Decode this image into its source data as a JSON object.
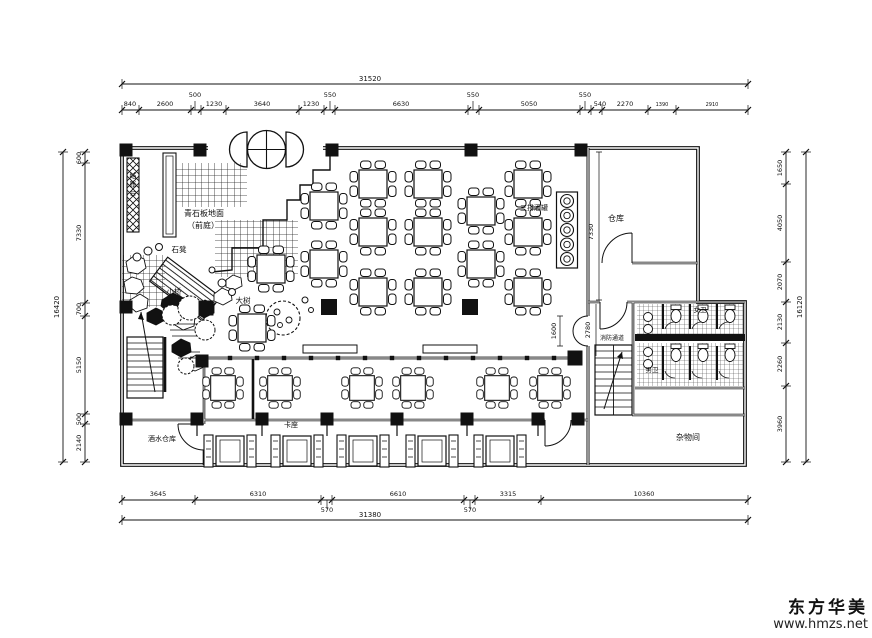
{
  "watermark": {
    "brand": "东方华美",
    "url": "www.hmzs.net"
  },
  "plan_labels": [
    {
      "id": "cashier-desk",
      "text": "结账台",
      "x": 133,
      "y": 178,
      "mode": "stack",
      "size": 7
    },
    {
      "id": "bluestone-paving",
      "text": "青石板地面",
      "x": 204,
      "y": 216,
      "mode": "h",
      "size": 8
    },
    {
      "id": "front-court",
      "text": "（前庭）",
      "x": 203,
      "y": 228,
      "mode": "h",
      "size": 8
    },
    {
      "id": "stone-bench",
      "text": "石凳",
      "x": 179,
      "y": 252,
      "mode": "h",
      "size": 7.5
    },
    {
      "id": "small-bridge",
      "text": "小桥",
      "x": 174,
      "y": 294,
      "mode": "h",
      "size": 7.5
    },
    {
      "id": "big-tree",
      "text": "大树",
      "x": 243,
      "y": 303,
      "mode": "h",
      "size": 7.5
    },
    {
      "id": "three-rows-wine-jars",
      "text": "三排酒罐",
      "x": 534,
      "y": 210,
      "mode": "h",
      "size": 7
    },
    {
      "id": "warehouse",
      "text": "仓库",
      "x": 616,
      "y": 221,
      "mode": "h",
      "size": 8
    },
    {
      "id": "dim-7330",
      "text": "7330",
      "x": 593,
      "y": 232,
      "mode": "rot",
      "size": 6.5
    },
    {
      "id": "dim-1600",
      "text": "1600",
      "x": 556,
      "y": 331,
      "mode": "rot",
      "size": 6.5
    },
    {
      "id": "dim-2780",
      "text": "2780",
      "x": 590,
      "y": 330,
      "mode": "rot",
      "size": 6.5
    },
    {
      "id": "fire-passage",
      "text": "消防通道",
      "x": 612,
      "y": 340,
      "mode": "h",
      "size": 6
    },
    {
      "id": "womens-wc",
      "text": "女卫",
      "x": 700,
      "y": 312,
      "mode": "h",
      "size": 6.5
    },
    {
      "id": "mens-wc",
      "text": "男卫",
      "x": 652,
      "y": 372,
      "mode": "h",
      "size": 6.5
    },
    {
      "id": "storage-room",
      "text": "杂物间",
      "x": 688,
      "y": 440,
      "mode": "h",
      "size": 8
    },
    {
      "id": "drinks-warehouse",
      "text": "酒水仓库",
      "x": 162,
      "y": 441,
      "mode": "h",
      "size": 7
    },
    {
      "id": "booth-seating",
      "text": "卡座",
      "x": 291,
      "y": 427,
      "mode": "h",
      "size": 7
    }
  ],
  "dim_chains": {
    "top": {
      "orient": "h",
      "total": "31520",
      "total_pos": 84,
      "total_label_at": 370,
      "a": 122,
      "b": 748,
      "seg_pos": 110,
      "ticks": [
        122,
        139,
        191,
        201,
        226,
        299,
        324,
        335,
        468,
        479,
        580,
        591,
        602,
        648,
        676,
        748
      ],
      "labels": [
        {
          "t": "840",
          "at": 130
        },
        {
          "t": "2600",
          "at": 165
        },
        {
          "t": "500",
          "at": 195,
          "raise": true
        },
        {
          "t": "1230",
          "at": 214
        },
        {
          "t": "3640",
          "at": 262
        },
        {
          "t": "1230",
          "at": 311
        },
        {
          "t": "550",
          "at": 330,
          "raise": true
        },
        {
          "t": "6630",
          "at": 401
        },
        {
          "t": "550",
          "at": 473,
          "raise": true
        },
        {
          "t": "5050",
          "at": 529
        },
        {
          "t": "550",
          "at": 585,
          "raise": true
        },
        {
          "t": "540",
          "at": 600
        },
        {
          "t": "2270",
          "at": 625
        },
        {
          "t": "1390",
          "at": 662,
          "small": true
        },
        {
          "t": "2910",
          "at": 712,
          "small": true
        }
      ]
    },
    "bottom": {
      "orient": "h",
      "total": "31380",
      "total_pos": 520,
      "total_label_at": 370,
      "a": 122,
      "b": 748,
      "seg_pos": 500,
      "ticks": [
        122,
        195,
        321,
        332,
        464,
        475,
        541,
        748
      ],
      "labels": [
        {
          "t": "3645",
          "at": 158
        },
        {
          "t": "6310",
          "at": 258
        },
        {
          "t": "570",
          "at": 327,
          "drop": true
        },
        {
          "t": "6610",
          "at": 398
        },
        {
          "t": "570",
          "at": 470,
          "drop": true
        },
        {
          "t": "3315",
          "at": 508
        },
        {
          "t": "10360",
          "at": 644
        }
      ]
    },
    "left": {
      "orient": "v",
      "total": "16420",
      "total_pos": 63,
      "total_label_at": 307,
      "a": 152,
      "b": 462,
      "seg_pos": 85,
      "ticks": [
        152,
        163,
        303,
        316,
        414,
        424,
        462
      ],
      "labels": [
        {
          "t": "600",
          "at": 158
        },
        {
          "t": "7330",
          "at": 233
        },
        {
          "t": "700",
          "at": 309
        },
        {
          "t": "5150",
          "at": 365
        },
        {
          "t": "500",
          "at": 419
        },
        {
          "t": "2140",
          "at": 443
        }
      ]
    },
    "right": {
      "orient": "v",
      "total": "16120",
      "total_pos": 806,
      "total_label_at": 307,
      "a": 152,
      "b": 462,
      "seg_pos": 786,
      "ticks": [
        152,
        184,
        262,
        302,
        343,
        386,
        462
      ],
      "labels": [
        {
          "t": "1650",
          "at": 168
        },
        {
          "t": "4050",
          "at": 223
        },
        {
          "t": "2070",
          "at": 282
        },
        {
          "t": "2130",
          "at": 322
        },
        {
          "t": "2260",
          "at": 364
        },
        {
          "t": "3960",
          "at": 424
        }
      ]
    }
  },
  "furniture": {
    "columns": [
      [
        126,
        150
      ],
      [
        200,
        150
      ],
      [
        332,
        150
      ],
      [
        471,
        150
      ],
      [
        581,
        150
      ],
      [
        126,
        307
      ],
      [
        126,
        419
      ],
      [
        206,
        308,
        15
      ],
      [
        329,
        307,
        16
      ],
      [
        470,
        307,
        16
      ],
      [
        202,
        361
      ],
      [
        575,
        358,
        15
      ],
      [
        197,
        419
      ],
      [
        262,
        419
      ],
      [
        327,
        419
      ],
      [
        397,
        419
      ],
      [
        467,
        419
      ],
      [
        538,
        419
      ],
      [
        578,
        419
      ]
    ],
    "dining_tables": [
      [
        324,
        206
      ],
      [
        324,
        264
      ],
      [
        271,
        269
      ],
      [
        252,
        328
      ],
      [
        373,
        184
      ],
      [
        373,
        232
      ],
      [
        373,
        292
      ],
      [
        428,
        184
      ],
      [
        428,
        232
      ],
      [
        428,
        292
      ],
      [
        481,
        211
      ],
      [
        481,
        264
      ],
      [
        528,
        184
      ],
      [
        528,
        232
      ],
      [
        528,
        292
      ]
    ],
    "mid_row_tables": [
      [
        223,
        388
      ],
      [
        280,
        388
      ],
      [
        362,
        388
      ],
      [
        413,
        388
      ],
      [
        497,
        388
      ],
      [
        550,
        388
      ]
    ],
    "booth_tables": [
      [
        230,
        451
      ],
      [
        297,
        451
      ],
      [
        363,
        451
      ],
      [
        432,
        451
      ],
      [
        500,
        451
      ]
    ],
    "bench_studs": {
      "y": 358,
      "x_start": 203,
      "x_end": 557,
      "step": 27
    },
    "wine_jar_rack": {
      "x": 567,
      "y_start": 201,
      "step": 14.5,
      "count": 5
    }
  }
}
